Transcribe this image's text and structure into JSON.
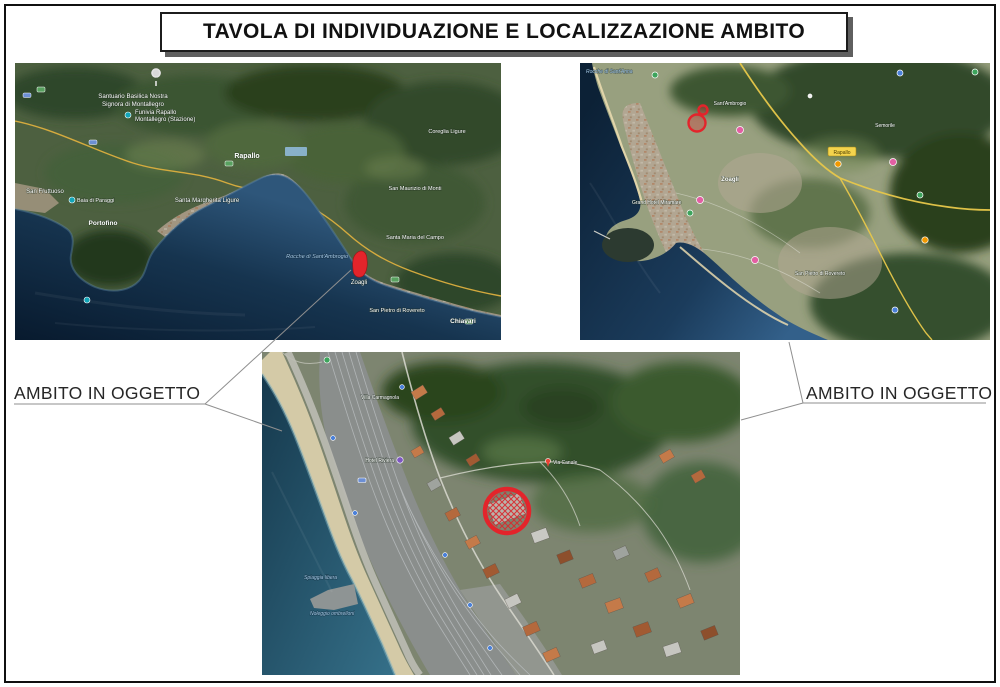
{
  "page": {
    "title": "TAVOLA DI INDIVIDUAZIONE E LOCALIZZAZIONE AMBITO"
  },
  "annotations": {
    "left_label": "AMBITO IN OGGETTO",
    "right_label": "AMBITO IN OGGETTO"
  },
  "colors": {
    "ambito_red": "#e3242b",
    "leader_line": "#8f8f8f",
    "title_shadow": "#5f5f5f",
    "sea_deep": "#0c2136",
    "sea_coast": "#33608a",
    "motorway_yellow": "#e8c84a"
  },
  "maps": {
    "overview": {
      "alt": "Satellite overview of the gulf coastline with the site marked in red",
      "labels": {
        "santuario_1": "Santuario Basilica Nostra",
        "santuario_2": "Signora di Montallegro",
        "funivia_1": "Funivia Rapallo",
        "funivia_2": "Montallegro (Stazione)",
        "rapallo": "Rapallo",
        "coreglia": "Coreglia Ligure",
        "santa_margherita": "Santa Margherita Ligure",
        "san_fruttuoso": "San Fruttuoso",
        "baia_di_paraggi": "Baia di Paraggi",
        "portofino": "Portofino",
        "san_maurizio": "San Maurizio di Monti",
        "santa_maria": "Santa Maria del Campo",
        "rocche": "Rocche di Sant'Ambrogio",
        "zoagli": "Zoagli",
        "san_pietro": "San Pietro di Rovereto",
        "chiavari": "Chiavari"
      }
    },
    "town": {
      "alt": "Closer satellite view of the town with the site marked in red",
      "labels": {
        "rocche": "Rocche di Sant'Anna",
        "sant_ambrogio": "Sant'Ambrogio",
        "semorile": "Semorile",
        "zoagli": "Zoagli",
        "grand_hotel": "Grand Hotel Miramare",
        "san_pietro": "San Pietro di Rovereto",
        "toll": "Rapallo"
      }
    },
    "site": {
      "alt": "Close-up satellite view of the site circled in red",
      "labels": {
        "villa": "Villa Carmagnola",
        "hotel": "Hotel Riviera",
        "via_canale": "Via Canale",
        "spiaggia": "Spiaggia libera",
        "noleggio": "Noleggio ombrelloni"
      }
    }
  }
}
